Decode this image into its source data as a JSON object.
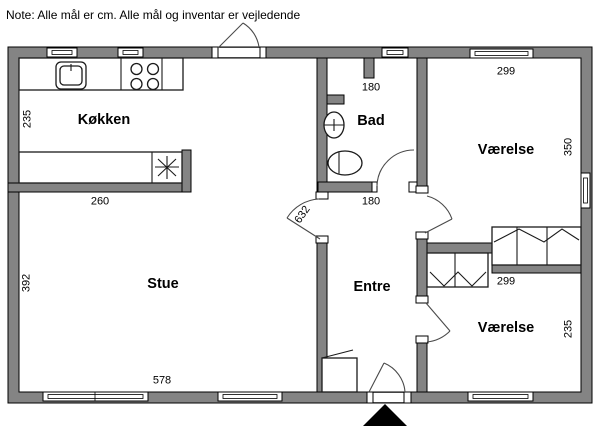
{
  "note": "Note: Alle mål er cm. Alle mål og inventar er vejledende",
  "colors": {
    "wall": "#848484",
    "outline": "#000000",
    "door_arc": "#4a4a4a",
    "background": "#ffffff"
  },
  "rooms": {
    "koekken": {
      "name": "Køkken",
      "dim_side": "235",
      "dim_bottom": "260"
    },
    "stue": {
      "name": "Stue",
      "dim_side": "392",
      "dim_bottom": "578"
    },
    "bad": {
      "name": "Bad",
      "dim_top": "180",
      "dim_bottom": "180"
    },
    "entre": {
      "name": "Entre",
      "dim_side": "632"
    },
    "vaerelse_top": {
      "name": "Værelse",
      "dim_top": "299",
      "dim_side": "350"
    },
    "vaerelse_bottom": {
      "name": "Værelse",
      "dim_top": "299",
      "dim_side": "235"
    }
  }
}
